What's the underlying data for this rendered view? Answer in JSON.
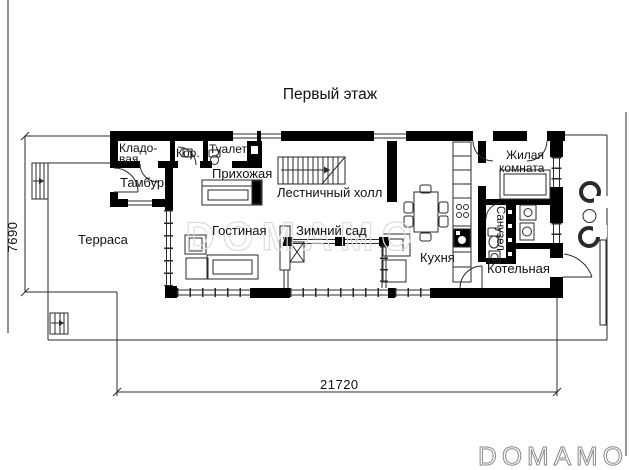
{
  "title": "Первый этаж",
  "rooms": {
    "terrace": "Терраса",
    "tambour": "Тамбур",
    "storage_line1": "Кладо-",
    "storage_line2": "вая",
    "corridor": "Кор.",
    "toilet": "Туалет",
    "hallway": "Прихожая",
    "stair_hall": "Лестничный холл",
    "living_room": "Гостиная",
    "winter_garden": "Зимний сад",
    "kitchen": "Кухня",
    "room_line1": "Жилая",
    "room_line2": "комната",
    "bathroom": "Санузел",
    "boiler_room": "Котельная"
  },
  "dimensions": {
    "height_mm": "7690",
    "width_mm": "21720"
  },
  "watermark": {
    "center": "DOMAMO",
    "logo": "DOMAMO"
  }
}
